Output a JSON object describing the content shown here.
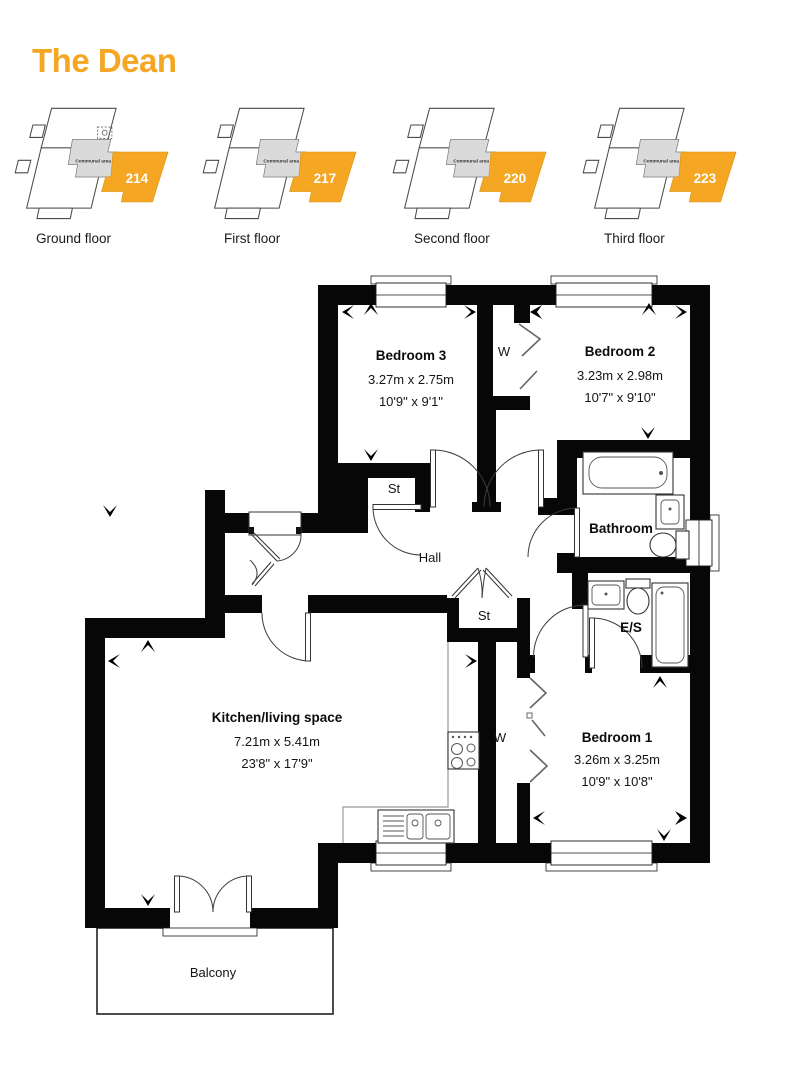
{
  "title": "The Dean",
  "colors": {
    "accent": "#F5A623",
    "communal_fill": "#DADADA",
    "wall": "#070707"
  },
  "locators": [
    {
      "floor_label": "Ground floor",
      "unit_number": "214",
      "communal_label": "Communal area"
    },
    {
      "floor_label": "First floor",
      "unit_number": "217",
      "communal_label": "Communal area"
    },
    {
      "floor_label": "Second floor",
      "unit_number": "220",
      "communal_label": "Communal area"
    },
    {
      "floor_label": "Third floor",
      "unit_number": "223",
      "communal_label": "Communal area"
    }
  ],
  "plan": {
    "rooms": {
      "bedroom3": {
        "name": "Bedroom 3",
        "metric": "3.27m x 2.75m",
        "imperial": "10'9\" x 9'1\""
      },
      "bedroom2": {
        "name": "Bedroom 2",
        "metric": "3.23m x 2.98m",
        "imperial": "10'7\" x 9'10\""
      },
      "bedroom1": {
        "name": "Bedroom 1",
        "metric": "3.26m x 3.25m",
        "imperial": "10'9\" x 10'8\""
      },
      "kitchen": {
        "name": "Kitchen/living space",
        "metric": "7.21m x 5.41m",
        "imperial": "23'8\" x 17'9\""
      },
      "bathroom": {
        "name": "Bathroom"
      },
      "ensuite": {
        "name": "E/S"
      },
      "hall": {
        "name": "Hall"
      },
      "store1": {
        "name": "St"
      },
      "store2": {
        "name": "St"
      },
      "wardrobe_top": {
        "name": "W"
      },
      "wardrobe_bed1": {
        "name": "W"
      },
      "balcony": {
        "name": "Balcony"
      }
    }
  }
}
